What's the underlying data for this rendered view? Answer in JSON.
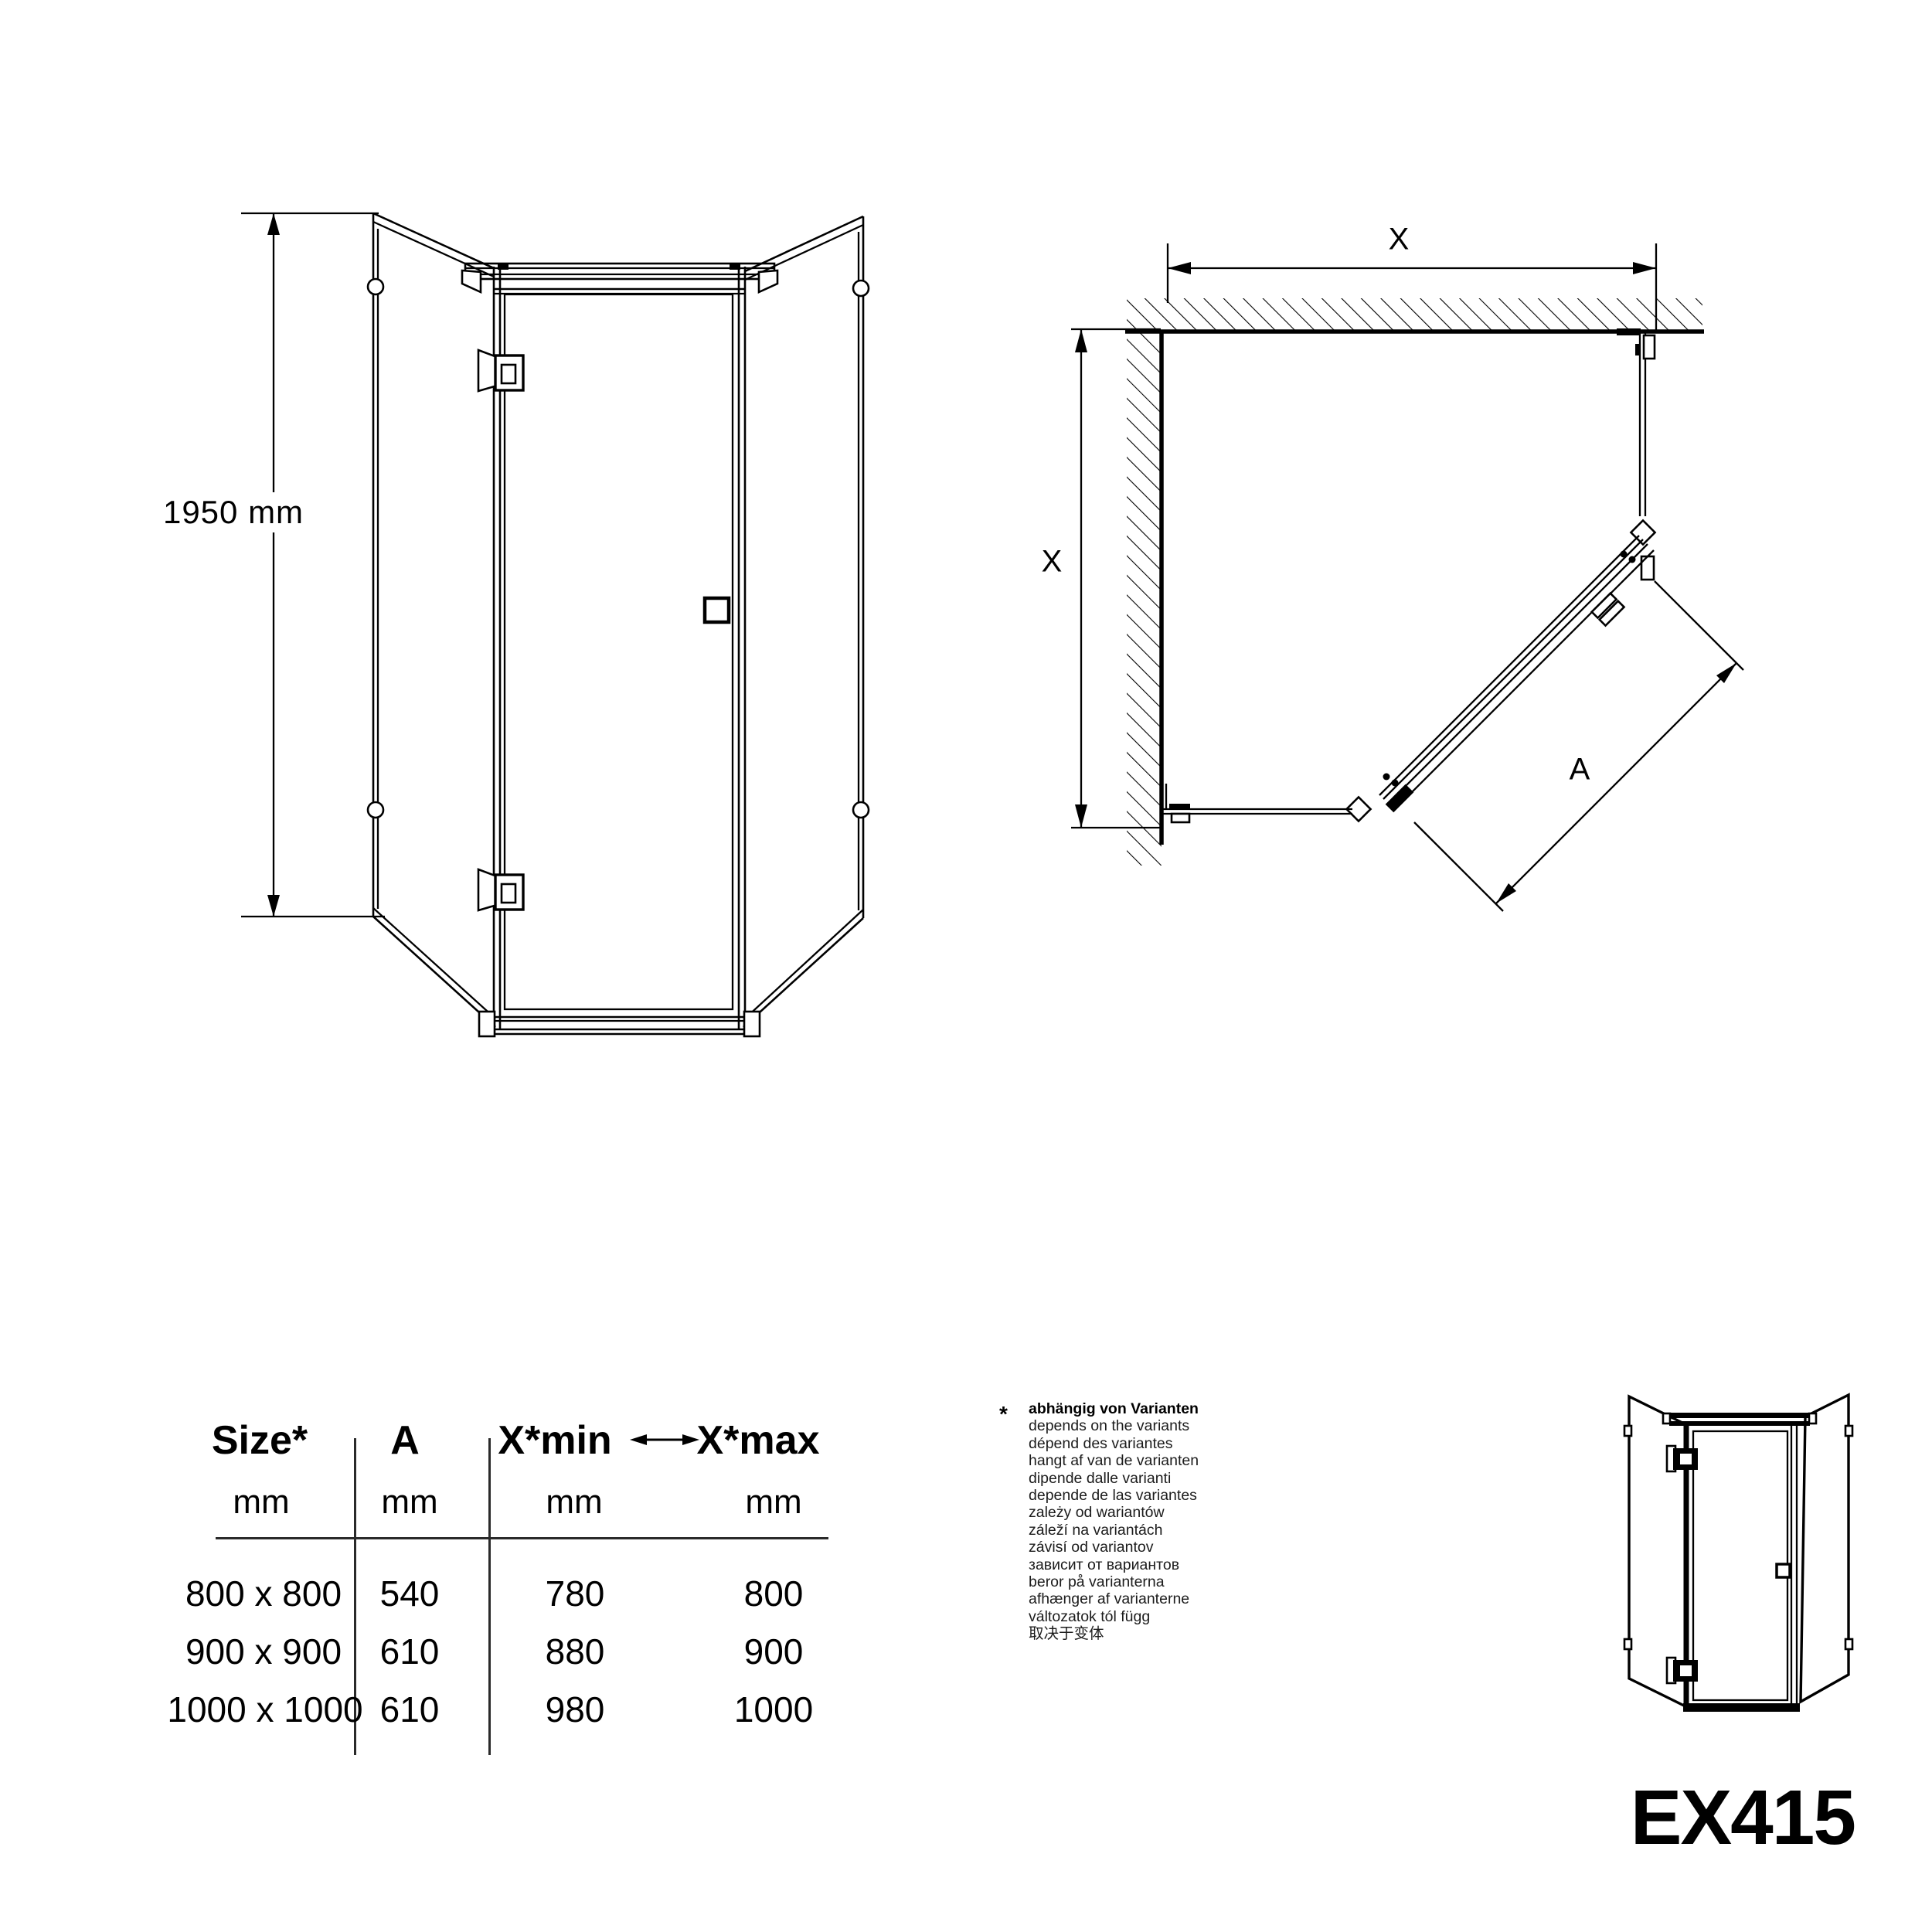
{
  "product": {
    "code": "EX415"
  },
  "front_view": {
    "height_label": "1950 mm"
  },
  "plan_view": {
    "width_label": "X",
    "depth_label": "X",
    "door_width_label": "A"
  },
  "table": {
    "headers": {
      "size": "Size*",
      "a": "A",
      "xmin": "X*min",
      "xmax": "X*max"
    },
    "unit": "mm",
    "rows": [
      [
        "800 x 800",
        "540",
        "780",
        "800"
      ],
      [
        "900 x 900",
        "610",
        "880",
        "900"
      ],
      [
        "1000 x 1000",
        "610",
        "980",
        "1000"
      ]
    ]
  },
  "note": {
    "marker": "*",
    "title": "abhängig von Varianten",
    "translations": [
      "depends on the variants",
      "dépend des variantes",
      "hangt af van de varianten",
      "dipende dalle varianti",
      "depende de las variantes",
      "zależy od wariantów",
      "záleží na variantách",
      "závisí od variantov",
      "зависит от вариантов",
      "beror på varianterna",
      "afhænger af varianterne",
      "változatok tól függ",
      "取决于变体"
    ]
  }
}
